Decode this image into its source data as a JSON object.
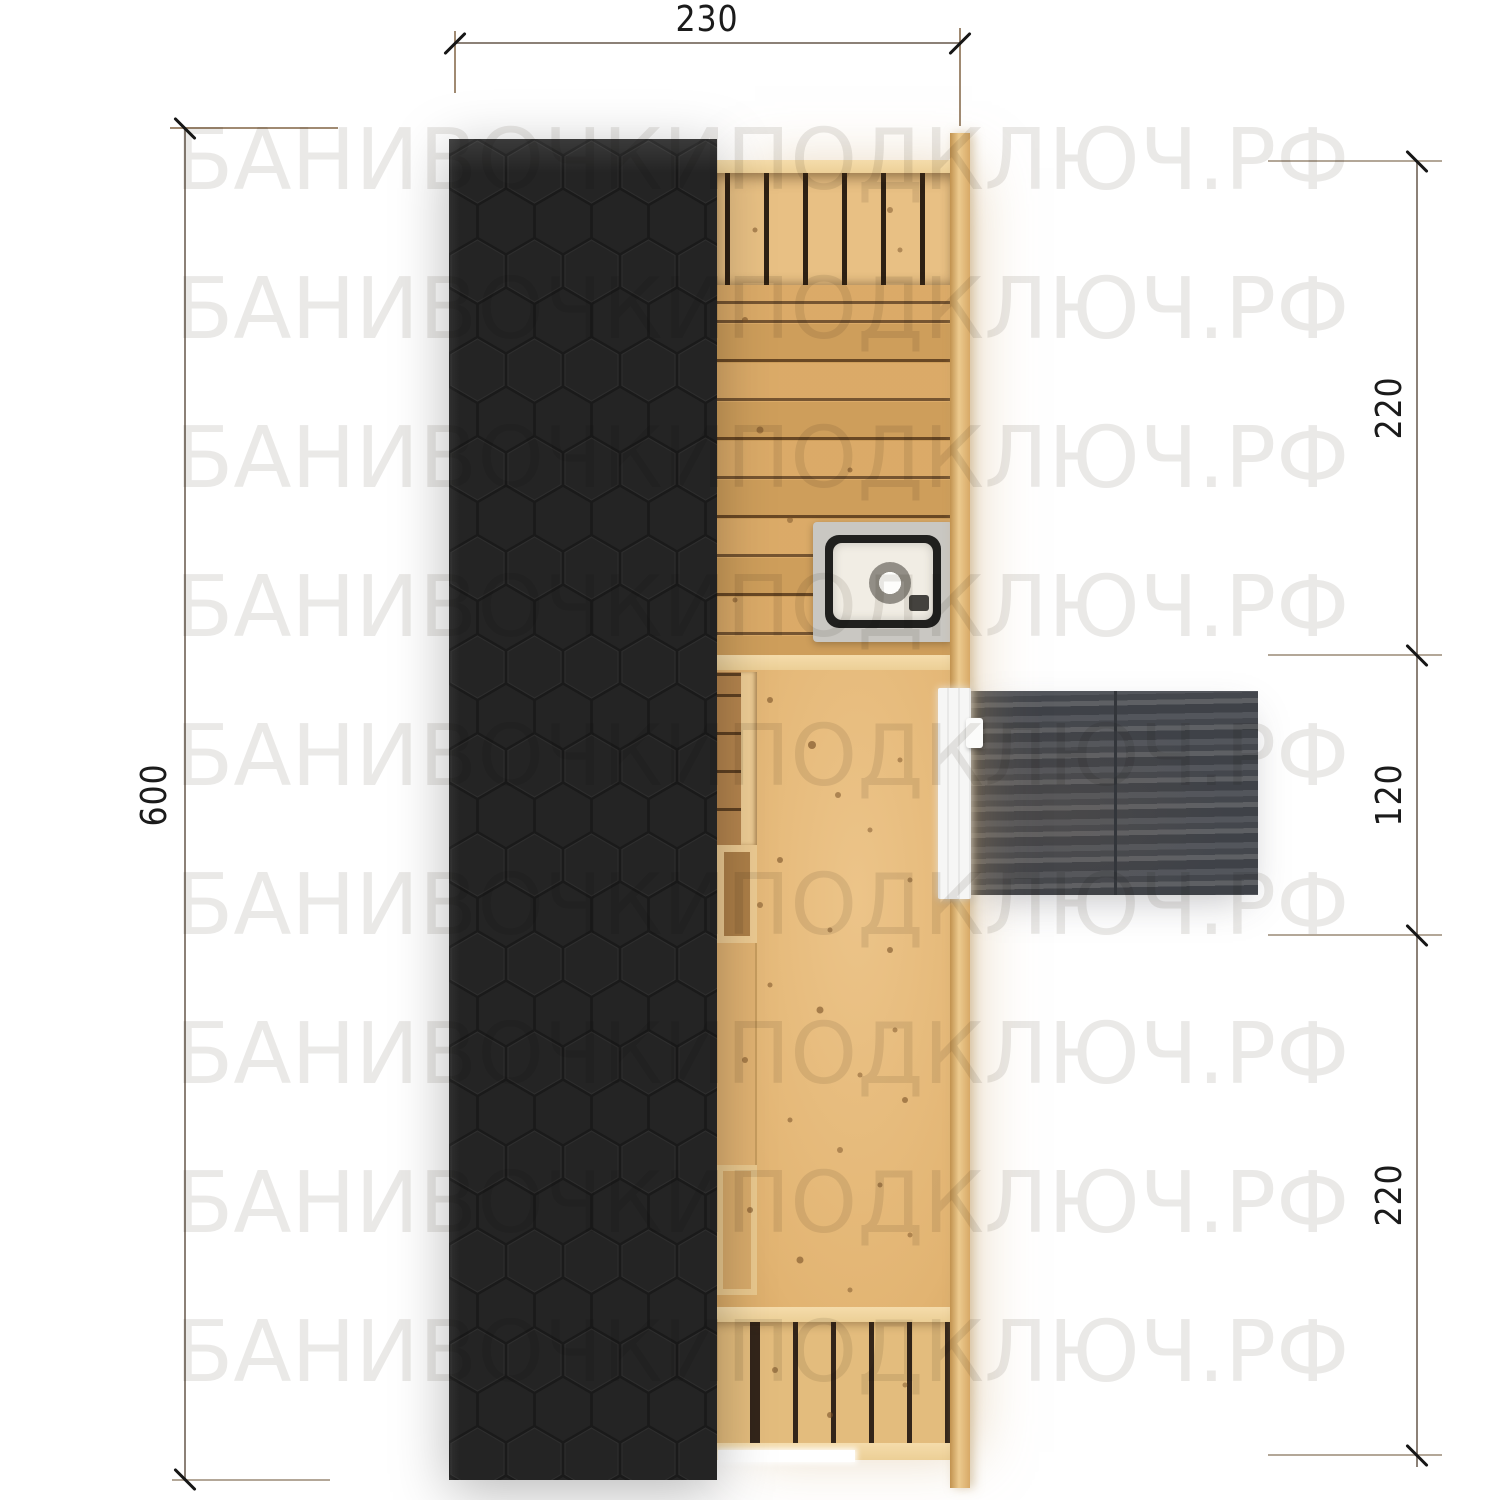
{
  "watermark": {
    "text": "БАНИВОЧКИПОДКЛЮЧ.РФ",
    "rows": 9
  },
  "dimensions": {
    "top_width": {
      "label": "230"
    },
    "left_height": {
      "label": "600"
    },
    "right_segments": [
      {
        "label": "220"
      },
      {
        "label": "120"
      },
      {
        "label": "220"
      }
    ]
  },
  "plan": {
    "colors": {
      "roof": "#242424",
      "roof_joint": "#1a1a1a",
      "wood_wall": "#f2d7a2",
      "wood_plank": "#d9a660",
      "wood_floor": "#e4b877",
      "terrace": "#4b4e54",
      "door": "#f6f6f5",
      "stove_rim": "#20201e",
      "dimension_text": "#1b1b1b"
    }
  }
}
